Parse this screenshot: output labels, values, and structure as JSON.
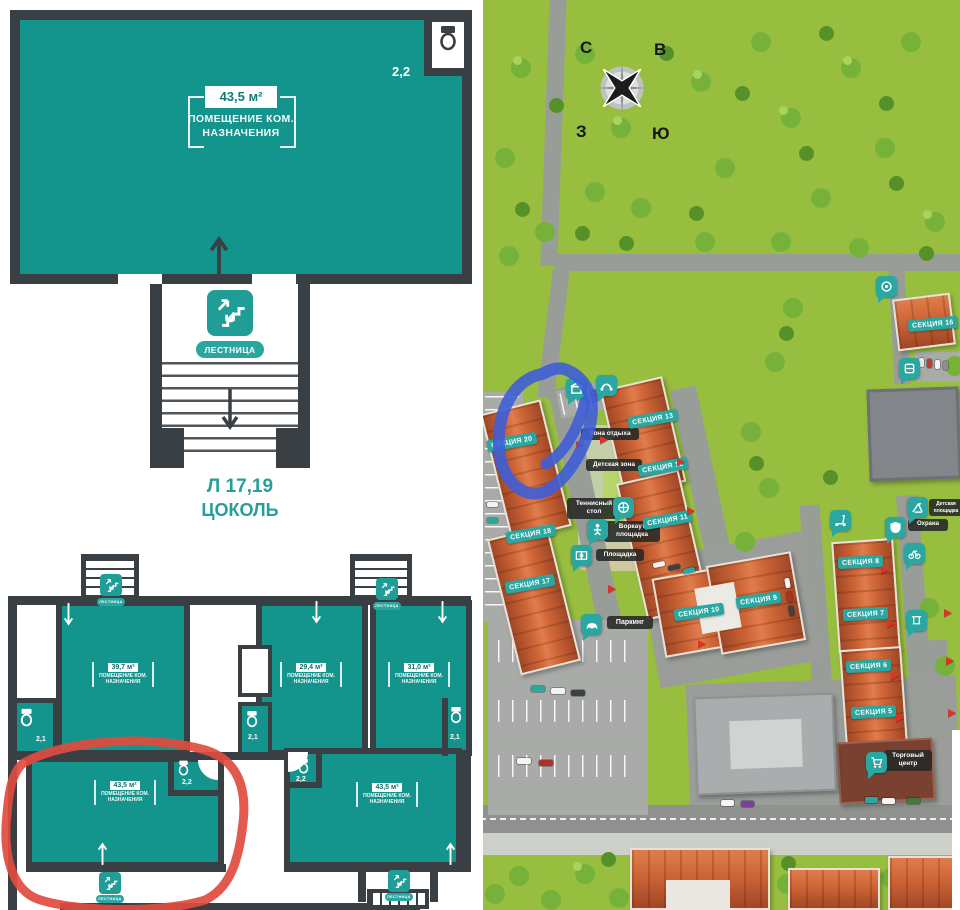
{
  "left_panel": {
    "detail_plan": {
      "area": "43,5 м²",
      "purpose": "ПОМЕЩЕНИЕ КОМ. НАЗНАЧЕНИЯ",
      "bath_area": "2,2",
      "stairs_label": "ЛЕСТНИЦА",
      "level_code": "Л 17,19",
      "level_name": "ЦОКОЛЬ"
    },
    "overview_plan": {
      "stairs_label": "ЛЕСТНИЦА",
      "units": [
        {
          "area": "39,7 м²",
          "purpose": "ПОМЕЩЕНИЕ КОМ. НАЗНАЧЕНИЯ",
          "bath_area": "2,1"
        },
        {
          "area": "29,4 м²",
          "purpose": "ПОМЕЩЕНИЕ КОМ. НАЗНАЧЕНИЯ",
          "bath_area": "2,1"
        },
        {
          "area": "31,0 м²",
          "purpose": "ПОМЕЩЕНИЕ КОМ. НАЗНАЧЕНИЯ",
          "bath_area": "2,1"
        },
        {
          "area": "43,5 м²",
          "purpose": "ПОМЕЩЕНИЕ КОМ. НАЗНАЧЕНИЯ",
          "bath_area": "2,2",
          "highlighted": true
        },
        {
          "area": "43,5 м²",
          "purpose": "ПОМЕЩЕНИЕ КОМ. НАЗНАЧЕНИЯ",
          "bath_area": "2,2"
        }
      ]
    }
  },
  "site_map": {
    "compass": {
      "north": "С",
      "east": "В",
      "west": "З",
      "south": "Ю"
    },
    "sections": [
      {
        "label": "СЕКЦИЯ 16"
      },
      {
        "label": "СЕКЦИЯ 13"
      },
      {
        "label": "СЕКЦИЯ 12"
      },
      {
        "label": "СЕКЦИЯ 11"
      },
      {
        "label": "СЕКЦИЯ 20",
        "highlighted": true
      },
      {
        "label": "СЕКЦИЯ 18"
      },
      {
        "label": "СЕКЦИЯ 17"
      },
      {
        "label": "СЕКЦИЯ 10"
      },
      {
        "label": "СЕКЦИЯ 9"
      },
      {
        "label": "СЕКЦИЯ 8"
      },
      {
        "label": "СЕКЦИЯ 7"
      },
      {
        "label": "СЕКЦИЯ 6"
      },
      {
        "label": "СЕКЦИЯ 5"
      }
    ],
    "amenities": {
      "rest_zone": "Зона отдыха",
      "kids_zone": "Детская зона",
      "tennis_table": "Теннисный стол",
      "workout": "Воркаут площадка",
      "playground": "Площадка",
      "parking": "Паркинг",
      "security": "Охрана",
      "mall": "Торговый центр",
      "kids_playground": "Детская площадка"
    }
  },
  "colors": {
    "floor_teal": "#13948c",
    "wall_dark": "#3a3f43",
    "accent_teal": "#2aa7a1",
    "map_green": "#98be40",
    "roof_red": "#cd6436",
    "highlight_blue": "#3f5ed6",
    "highlight_red": "#e2493c"
  },
  "icons": [
    "stairs-icon",
    "toilet-icon",
    "compass-rose",
    "car-icon",
    "shield-icon",
    "basketball-icon",
    "workout-icon",
    "sport-field-icon",
    "shopping-cart-icon",
    "playground-slide-icon",
    "scooter-icon",
    "kiosk-icon",
    "swing-icon",
    "bike-icon",
    "path-icon",
    "store-icon"
  ]
}
